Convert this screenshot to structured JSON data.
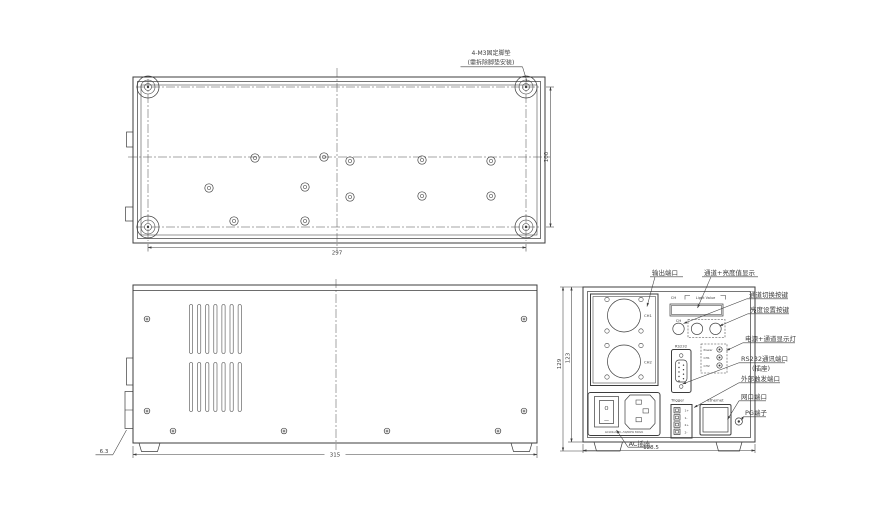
{
  "colors": {
    "line": "#3d3d3d",
    "background": "#ffffff"
  },
  "top_view": {
    "note_line1": "4-M3固定脚垫",
    "note_line2": "(需拆除脚垫安装)",
    "dim_width": "297",
    "dim_height": "100"
  },
  "side_view": {
    "dim_width": "315",
    "dim_tab": "6.3"
  },
  "rear_view": {
    "dim_width": "128.5",
    "dim_height_outer": "129",
    "dim_height_body": "123",
    "display_ch_label": "CH",
    "display_value_label": "Light Value",
    "knob_ch_label": "CH",
    "output_ch1": "CH1",
    "output_ch2": "CH2",
    "rs232_label": "RS232",
    "led_power": "Power",
    "led_ch1": "CH1",
    "led_ch2": "CH2",
    "trigger_label": "Trigger",
    "trigger_pins": [
      "1+",
      "1-",
      "2+",
      "2-"
    ],
    "ethernet_label": "Ethernet",
    "switch_off_symbol": "O",
    "switch_on_symbol": "—",
    "ac_rating": "AC100-240V~50/60Hz 300VA"
  },
  "callouts": {
    "output_port": "输出端口",
    "channel_display": "通道+亮度值显示",
    "channel_switch_key": "通道切换按键",
    "brightness_set_key": "亮度设置按键",
    "power_channel_leds": "电源+通道显示灯",
    "rs232_port_line1": "RS232通讯端口",
    "rs232_port_line2": "(插座)",
    "external_trigger_port": "外部触发端口",
    "lan_port": "网口端口",
    "pg_terminal": "PG端子",
    "ac_socket": "AC插座"
  }
}
